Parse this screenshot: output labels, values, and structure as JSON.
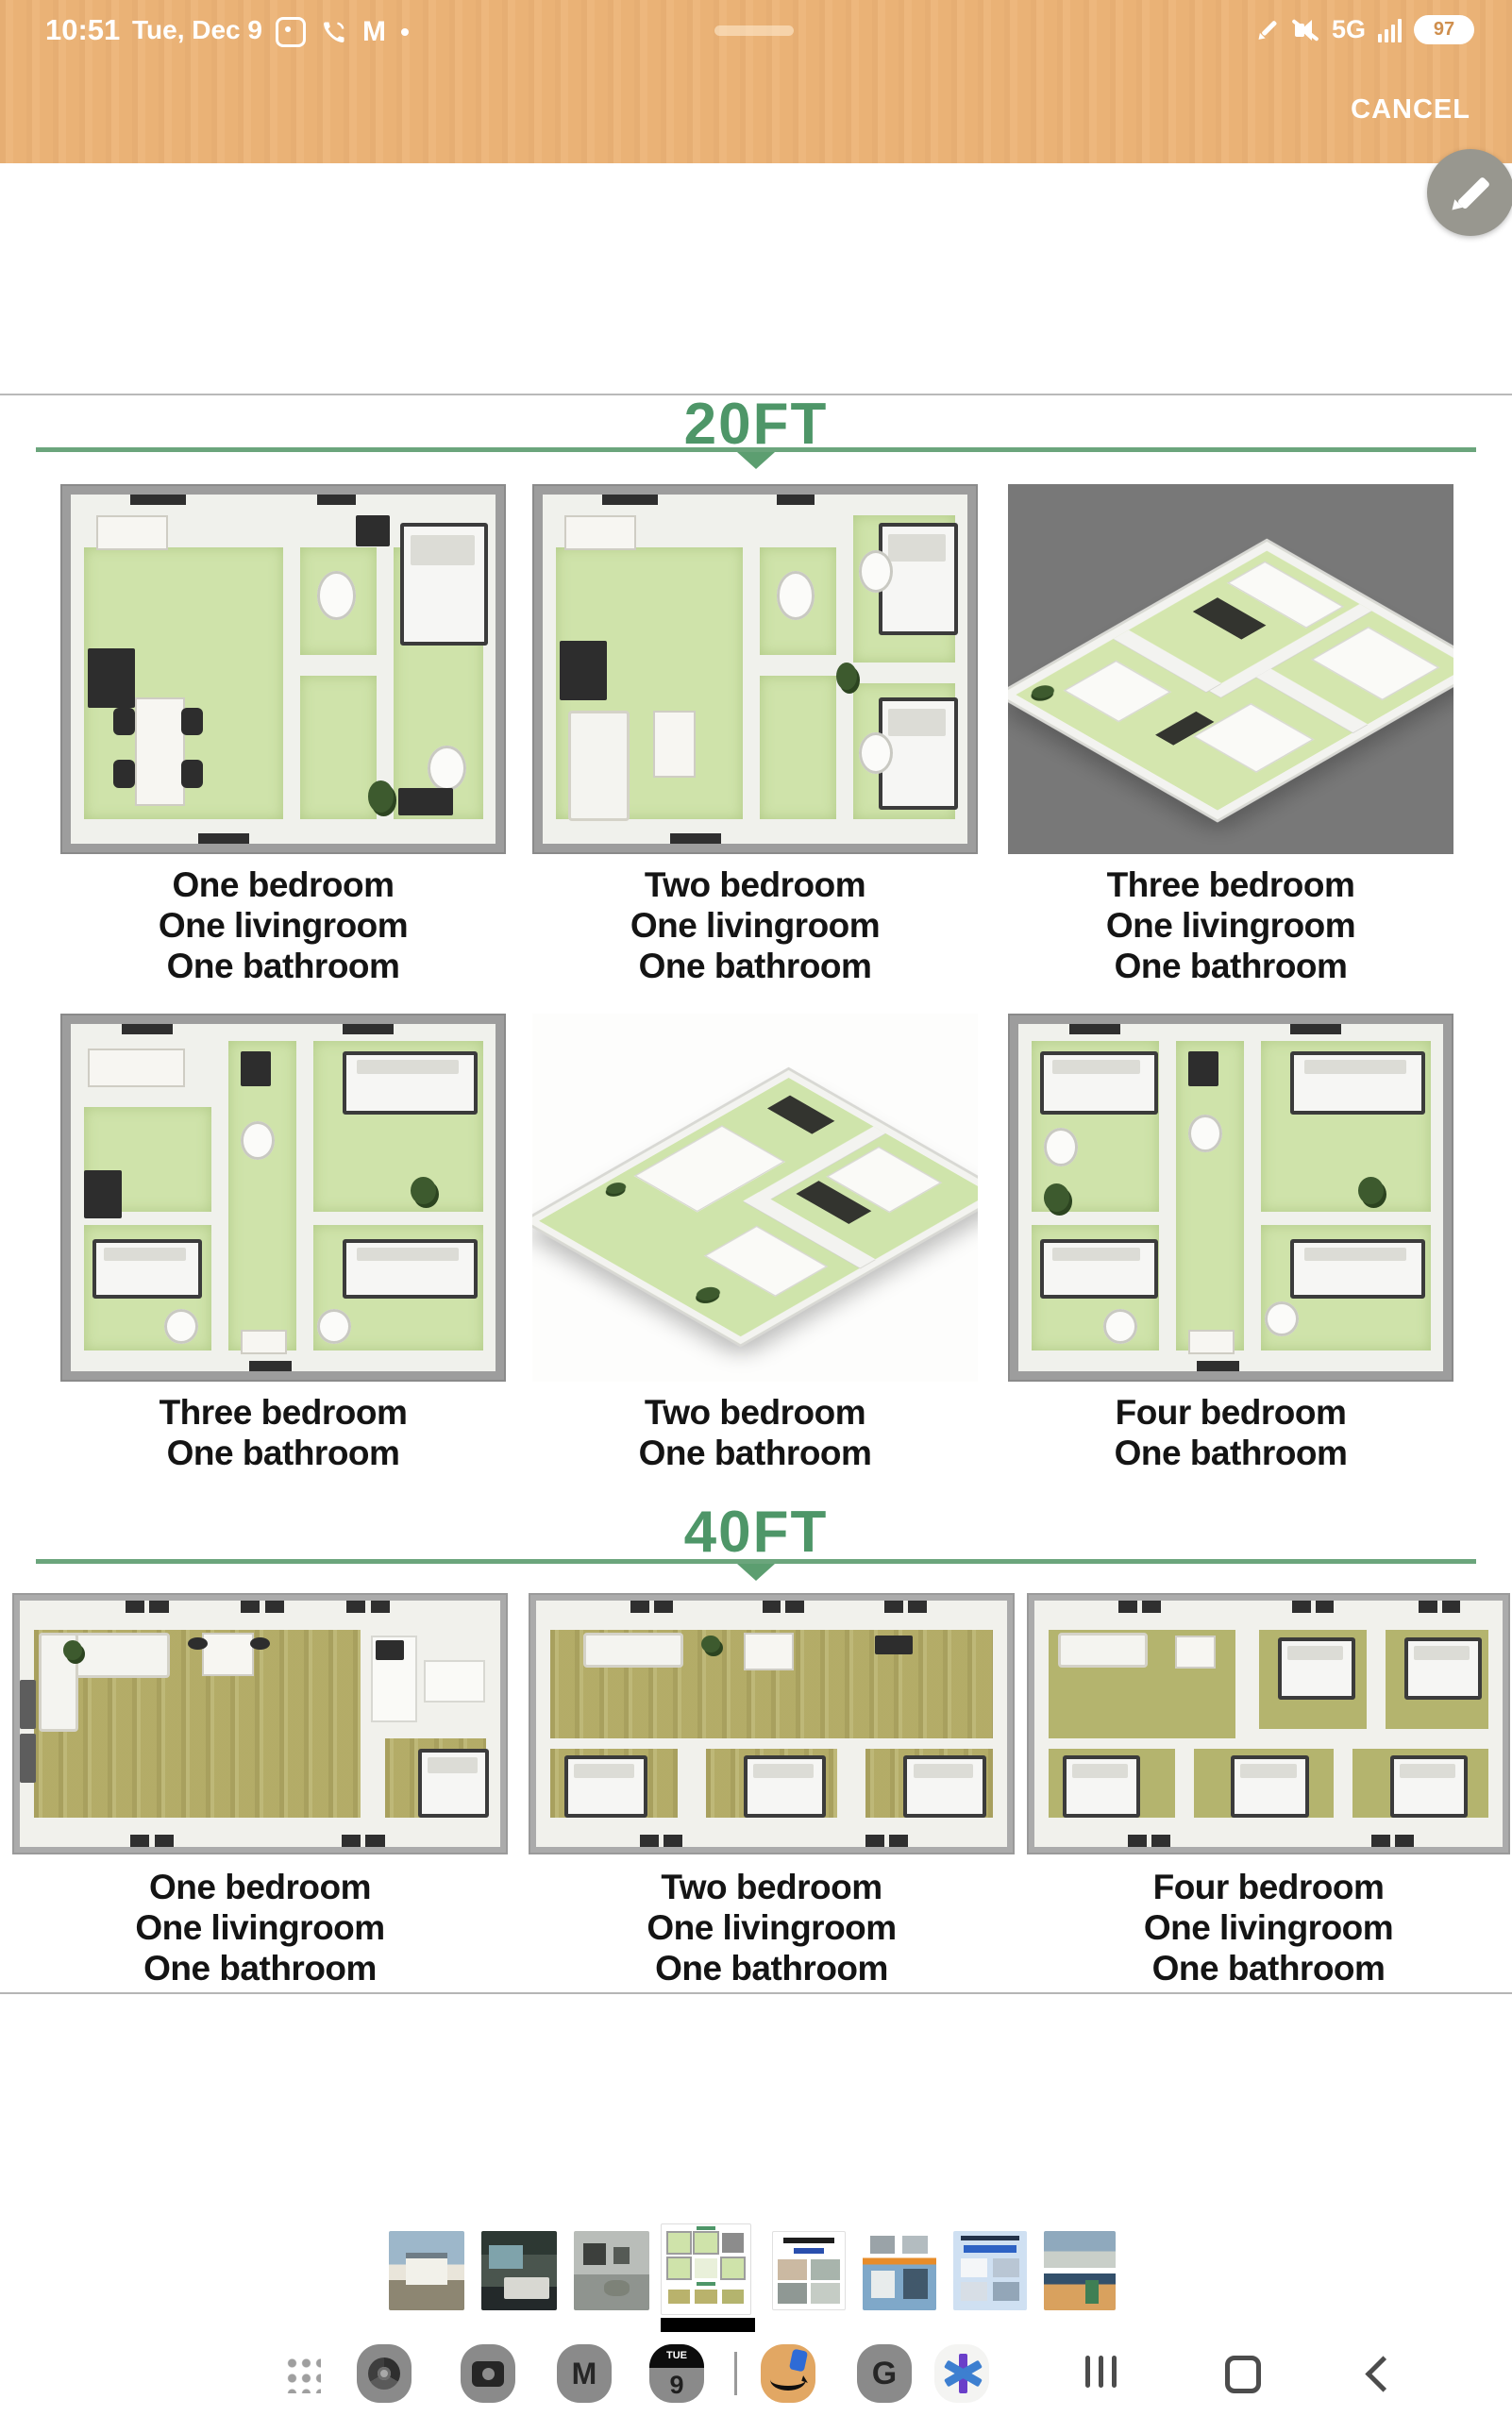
{
  "status_bar": {
    "time": "10:51",
    "date": "Tue, Dec 9",
    "network": "5G",
    "battery_percent": "97",
    "notification_icons": [
      "screenshot-icon",
      "phone-icon",
      "gmail-icon",
      "notification-dot"
    ],
    "right_icons": [
      "stylus-icon",
      "mute-icon",
      "signal-bars-icon",
      "battery-pill"
    ]
  },
  "action_bar": {
    "cancel_label": "CANCEL",
    "edit_icon": "pencil-icon"
  },
  "document": {
    "sections": [
      {
        "title": "20FT"
      },
      {
        "title": "40FT"
      }
    ],
    "captions": {
      "row1": [
        [
          "One bedroom",
          "One livingroom",
          "One bathroom"
        ],
        [
          "Two bedroom",
          "One livingroom",
          "One bathroom"
        ],
        [
          "Three bedroom",
          "One livingroom",
          "One bathroom"
        ]
      ],
      "row2": [
        [
          "Three bedroom",
          "One bathroom"
        ],
        [
          "Two bedroom",
          "One bathroom"
        ],
        [
          "Four bedroom",
          "One bathroom"
        ]
      ],
      "row3": [
        [
          "One bedroom",
          "One livingroom",
          "One bathroom"
        ],
        [
          "Two bedroom",
          "One livingroom",
          "One bathroom"
        ],
        [
          "Four bedroom",
          "One livingroom",
          "One bathroom"
        ]
      ]
    }
  },
  "thumbnails": [
    {
      "name": "house-exterior-photo",
      "selected": false
    },
    {
      "name": "bedroom-interior-photo",
      "selected": false
    },
    {
      "name": "livingroom-interior-photo",
      "selected": false
    },
    {
      "name": "floor-plans-sheet",
      "selected": true
    },
    {
      "name": "internal-display-sheet",
      "selected": false
    },
    {
      "name": "installation-steps-sheet",
      "selected": false
    },
    {
      "name": "product-advantages-sheet",
      "selected": false
    },
    {
      "name": "container-exterior-photos",
      "selected": false
    }
  ],
  "dock": {
    "apps": [
      "apps-grid",
      "chrome",
      "camera",
      "gmail",
      "calendar",
      "amazon",
      "google",
      "asterisk-app"
    ],
    "calendar": {
      "weekday": "TUE",
      "day": "9"
    },
    "nav": [
      "recents",
      "home",
      "back"
    ]
  },
  "colors": {
    "header_orange": "#ecb478",
    "accent_green": "#4e9668",
    "floor_green": "#cfe3aa",
    "floor_olive": "#b9b26c"
  }
}
